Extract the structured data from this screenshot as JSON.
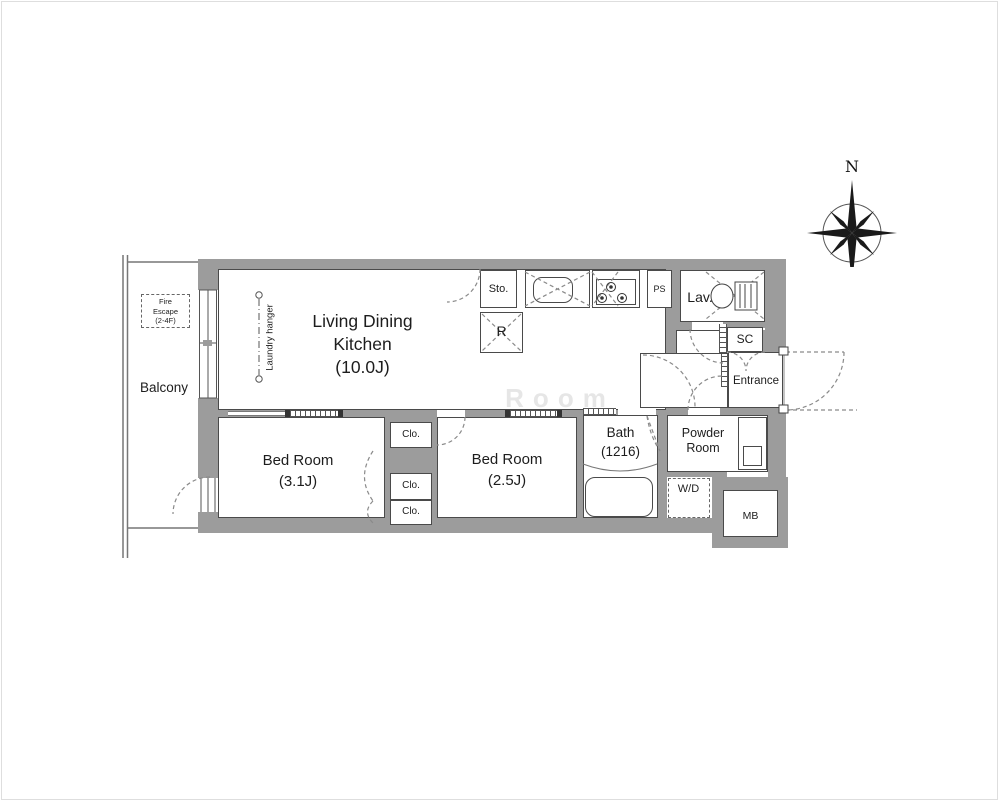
{
  "plan": {
    "balcony": {
      "label": "Balcony"
    },
    "fire_escape": {
      "line1": "Fire",
      "line2": "Escape",
      "line3": "(2-4F)"
    },
    "laundry_hanger": {
      "label": "Laundry hanger"
    },
    "rooms": {
      "ldk": {
        "line1": "Living Dining",
        "line2": "Kitchen",
        "line3": "(10.0J)"
      },
      "bedroom_31": {
        "line1": "Bed Room",
        "line2": "(3.1J)"
      },
      "bedroom_25": {
        "line1": "Bed Room",
        "line2": "(2.5J)"
      },
      "bath": {
        "line1": "Bath",
        "line2": "(1216)"
      },
      "powder_room": {
        "line1": "Powder",
        "line2": "Room"
      },
      "entrance": {
        "label": "Entrance"
      }
    },
    "fixtures": {
      "storage": "Sto.",
      "refrigerator": "R",
      "pipe_space": "PS",
      "lavatory": "Lav.",
      "shoe_closet": "SC",
      "closets": [
        "Clo.",
        "Clo.",
        "Clo."
      ],
      "washer_dryer": "W/D",
      "meter_box": "MB"
    },
    "compass": {
      "north": "N"
    },
    "watermark": "Room",
    "colors": {
      "wall": "#9c9c9c",
      "line": "#4a4a4a",
      "dash": "#8a8a8a",
      "text": "#1d1d1d"
    }
  }
}
